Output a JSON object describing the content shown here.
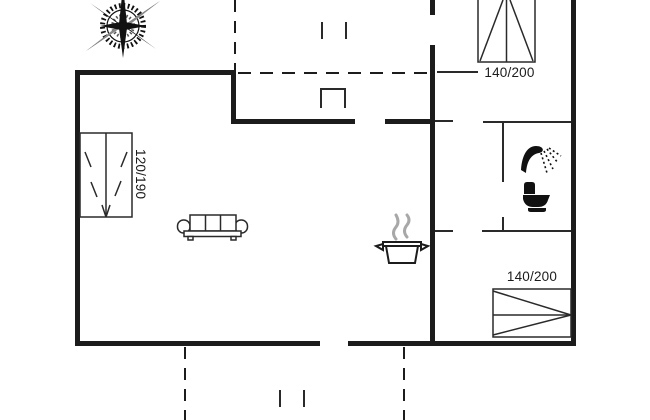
{
  "plan": {
    "type": "holiday-home-floorplan",
    "bed_left": {
      "label": "120/190"
    },
    "bed_top_right": {
      "label": "140/200"
    },
    "bed_bottom_right": {
      "label": "140/200"
    },
    "icons": {
      "compass": "compass-rose-icon",
      "sofa": "sofa-icon",
      "pot": "cooking-pot-icon",
      "steam": "steam-icon",
      "shower": "shower-icon",
      "toilet": "toilet-icon"
    },
    "colors": {
      "wall": "#1c1c1c",
      "furniture_line": "#2a2a2a",
      "steam": "#a8a8a8",
      "background": "#ffffff"
    }
  }
}
